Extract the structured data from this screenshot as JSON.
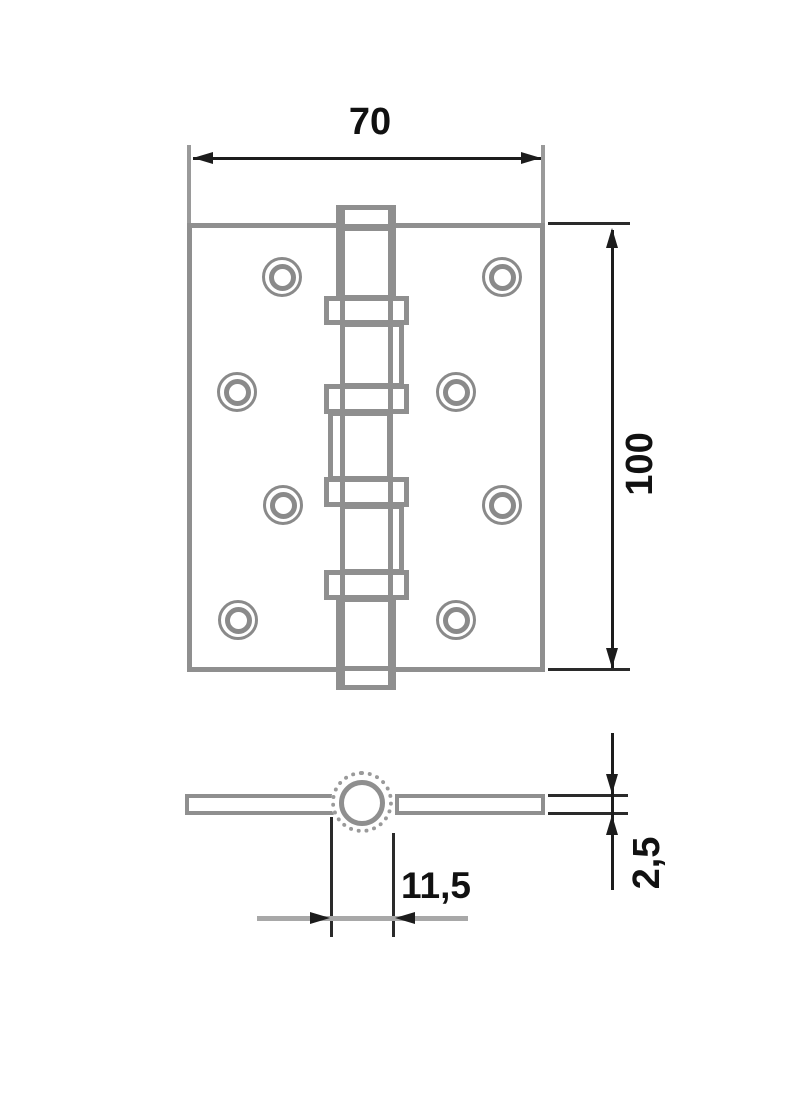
{
  "diagram": {
    "type": "technical-drawing",
    "subject": "door butt hinge, front view and cross-section",
    "labels": {
      "plate_width": "70",
      "plate_height": "100",
      "knuckle_offset": "11,5",
      "leaf_thickness": "2,5"
    },
    "colors": {
      "drawing_line": "#8f8f8f",
      "dimension_line": "#1c1c1c",
      "dimension_line_gray": "#a8a8a8",
      "background": "#ffffff"
    }
  }
}
